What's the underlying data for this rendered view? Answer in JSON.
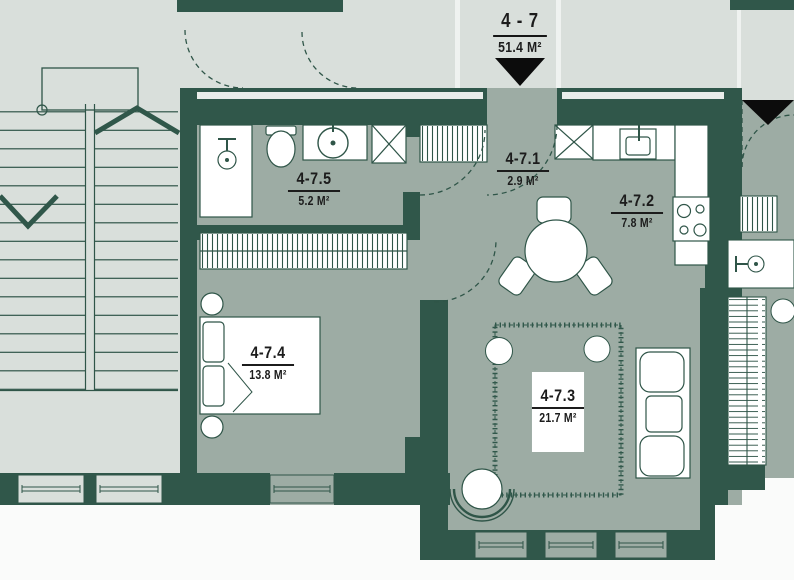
{
  "plan": {
    "title": {
      "number": "4 - 7",
      "area": "51.4 M²"
    },
    "rooms": [
      {
        "id": "room-4-7-1",
        "number": "4-7.1",
        "area": "2.9 M²"
      },
      {
        "id": "room-4-7-2",
        "number": "4-7.2",
        "area": "7.8 M²"
      },
      {
        "id": "room-4-7-3",
        "number": "4-7.3",
        "area": "21.7 M²"
      },
      {
        "id": "room-4-7-4",
        "number": "4-7.4",
        "area": "13.8 M²"
      },
      {
        "id": "room-4-7-5",
        "number": "4-7.5",
        "area": "5.2 M²"
      }
    ],
    "icons": {
      "entrance_marker": "▼",
      "ventilation_shaft": "☒",
      "stair_direction": "⌃"
    },
    "colors": {
      "wall": "#30574A",
      "apartment_floor": "#9DACA4",
      "common_area": "#D9DFDB",
      "fixture_fill": "#FFFFFF",
      "entrance_marker": "#0C0C0C",
      "label_text": "#1C1C1C"
    }
  }
}
